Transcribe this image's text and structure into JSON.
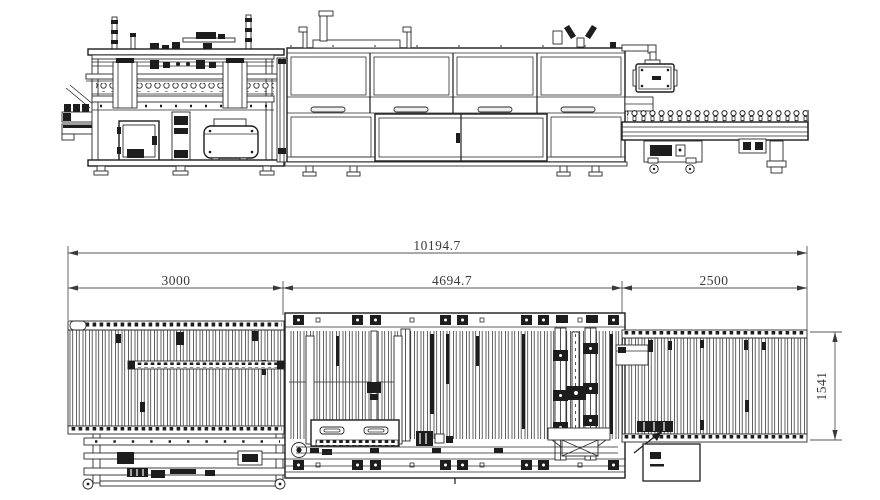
{
  "drawing": {
    "background": "#ffffff",
    "colors": {
      "line": "#1d1d1d",
      "fine_line": "#2a2a2a",
      "dimension_line": "#555555",
      "dimension_text": "#3a3a3a"
    },
    "plan_dimensions": {
      "overall_length": "10194.7",
      "infeed_length": "3000",
      "machine_length": "4694.7",
      "outfeed_length": "2500",
      "conveyor_width": "1541"
    }
  }
}
